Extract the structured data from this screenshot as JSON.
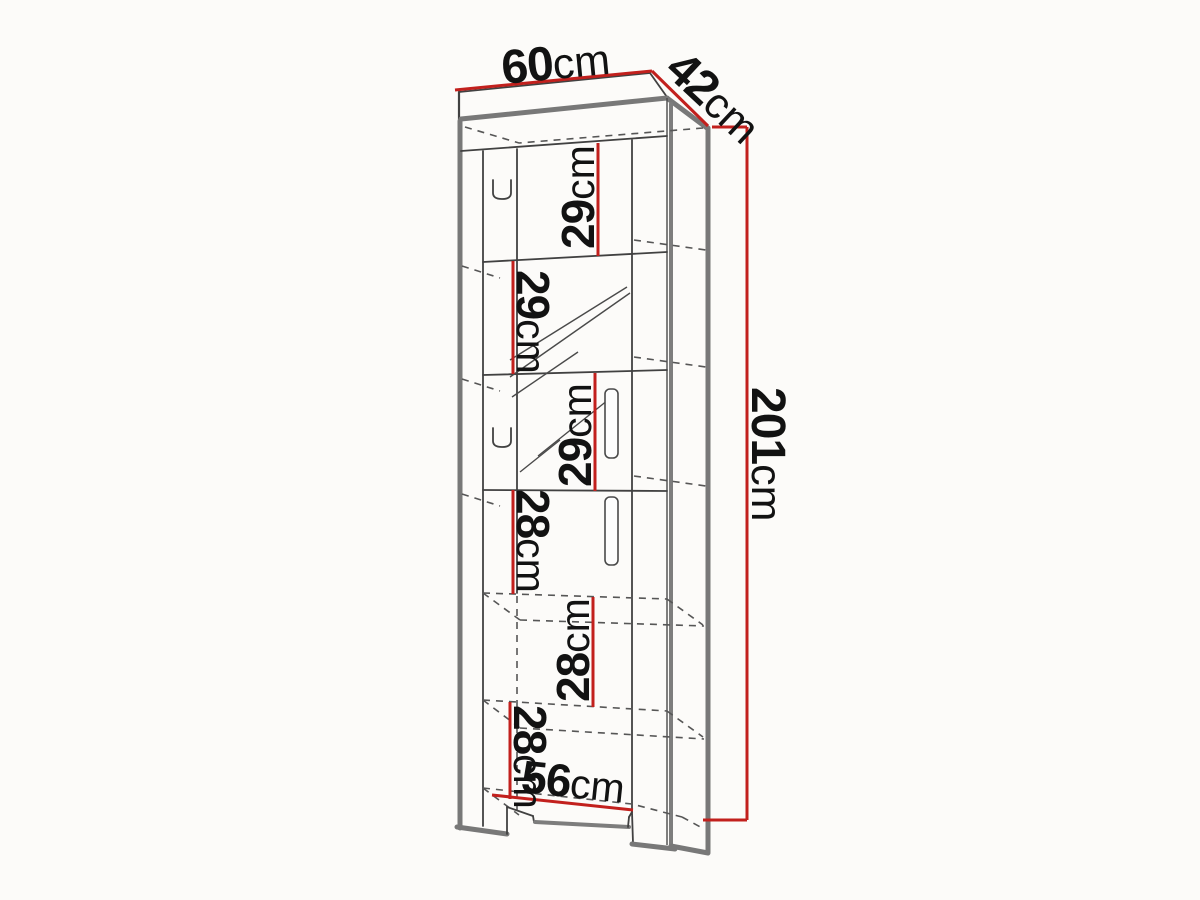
{
  "drawing": {
    "type": "furniture-technical-drawing",
    "subject": "tall-display-cabinet",
    "colors": {
      "dimension_red": "#c2201d",
      "line_dark": "#414141",
      "frame_gray": "#787878",
      "background": "#fcfbf9"
    },
    "dimensions": {
      "width": {
        "value": "60",
        "unit": "cm"
      },
      "depth": {
        "value": "42",
        "unit": "cm"
      },
      "height": {
        "value": "201",
        "unit": "cm"
      },
      "inner_width": {
        "value": "56",
        "unit": "cm"
      },
      "compartments": [
        {
          "value": "29",
          "unit": "cm"
        },
        {
          "value": "29",
          "unit": "cm"
        },
        {
          "value": "29",
          "unit": "cm"
        },
        {
          "value": "28",
          "unit": "cm"
        },
        {
          "value": "28",
          "unit": "cm"
        },
        {
          "value": "28",
          "unit": "cm"
        }
      ]
    }
  }
}
